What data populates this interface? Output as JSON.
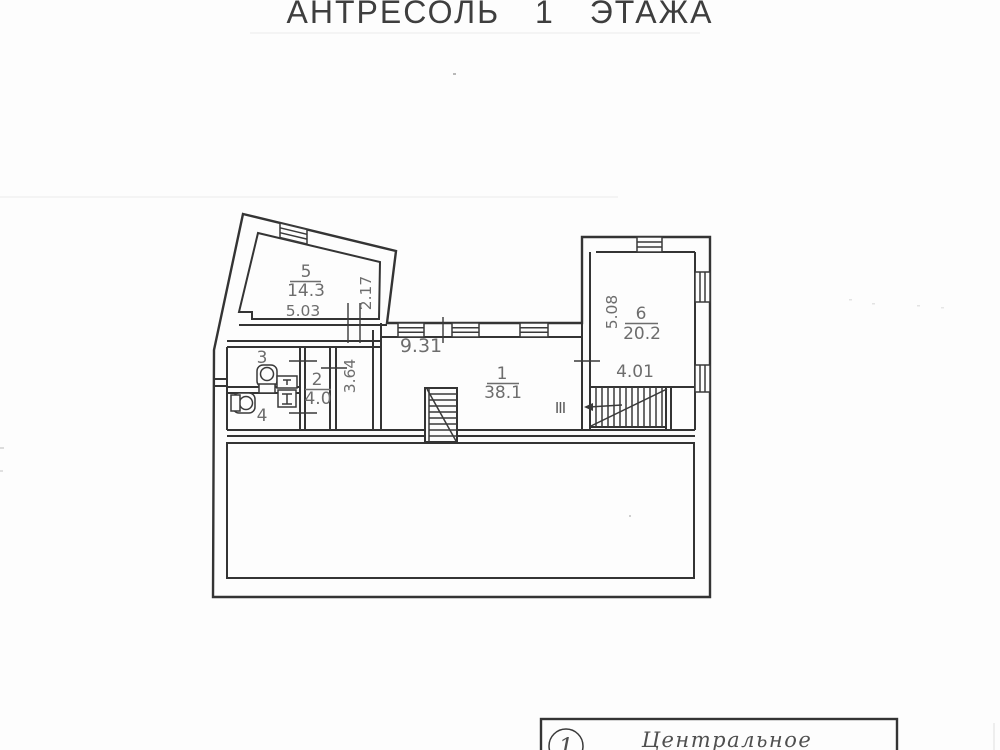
{
  "page": {
    "title": "АНТРЕСОЛЬ 1 ЭТАЖА"
  },
  "rooms": {
    "room1": {
      "number": "1",
      "area": "38.1"
    },
    "room2": {
      "number": "2",
      "area": "4.0"
    },
    "room3": {
      "number": "3"
    },
    "room4": {
      "number": "4"
    },
    "room5": {
      "number": "5",
      "area": "14.3"
    },
    "room6": {
      "number": "6",
      "area": "20.2"
    }
  },
  "dimensions": {
    "room5_width": "5.03",
    "room5_depth": "2.17",
    "hall_depth": "3.64",
    "room1_width": "9.31",
    "room6_depth": "5.08",
    "room6_width": "4.01"
  },
  "stairwell_mark": "III",
  "stamp": {
    "sheet_number": "1",
    "district_label": "Центральное"
  },
  "colors": {
    "ink": "#343434",
    "label_gray": "#6d6d6d",
    "paper": "#fdfdfd"
  }
}
